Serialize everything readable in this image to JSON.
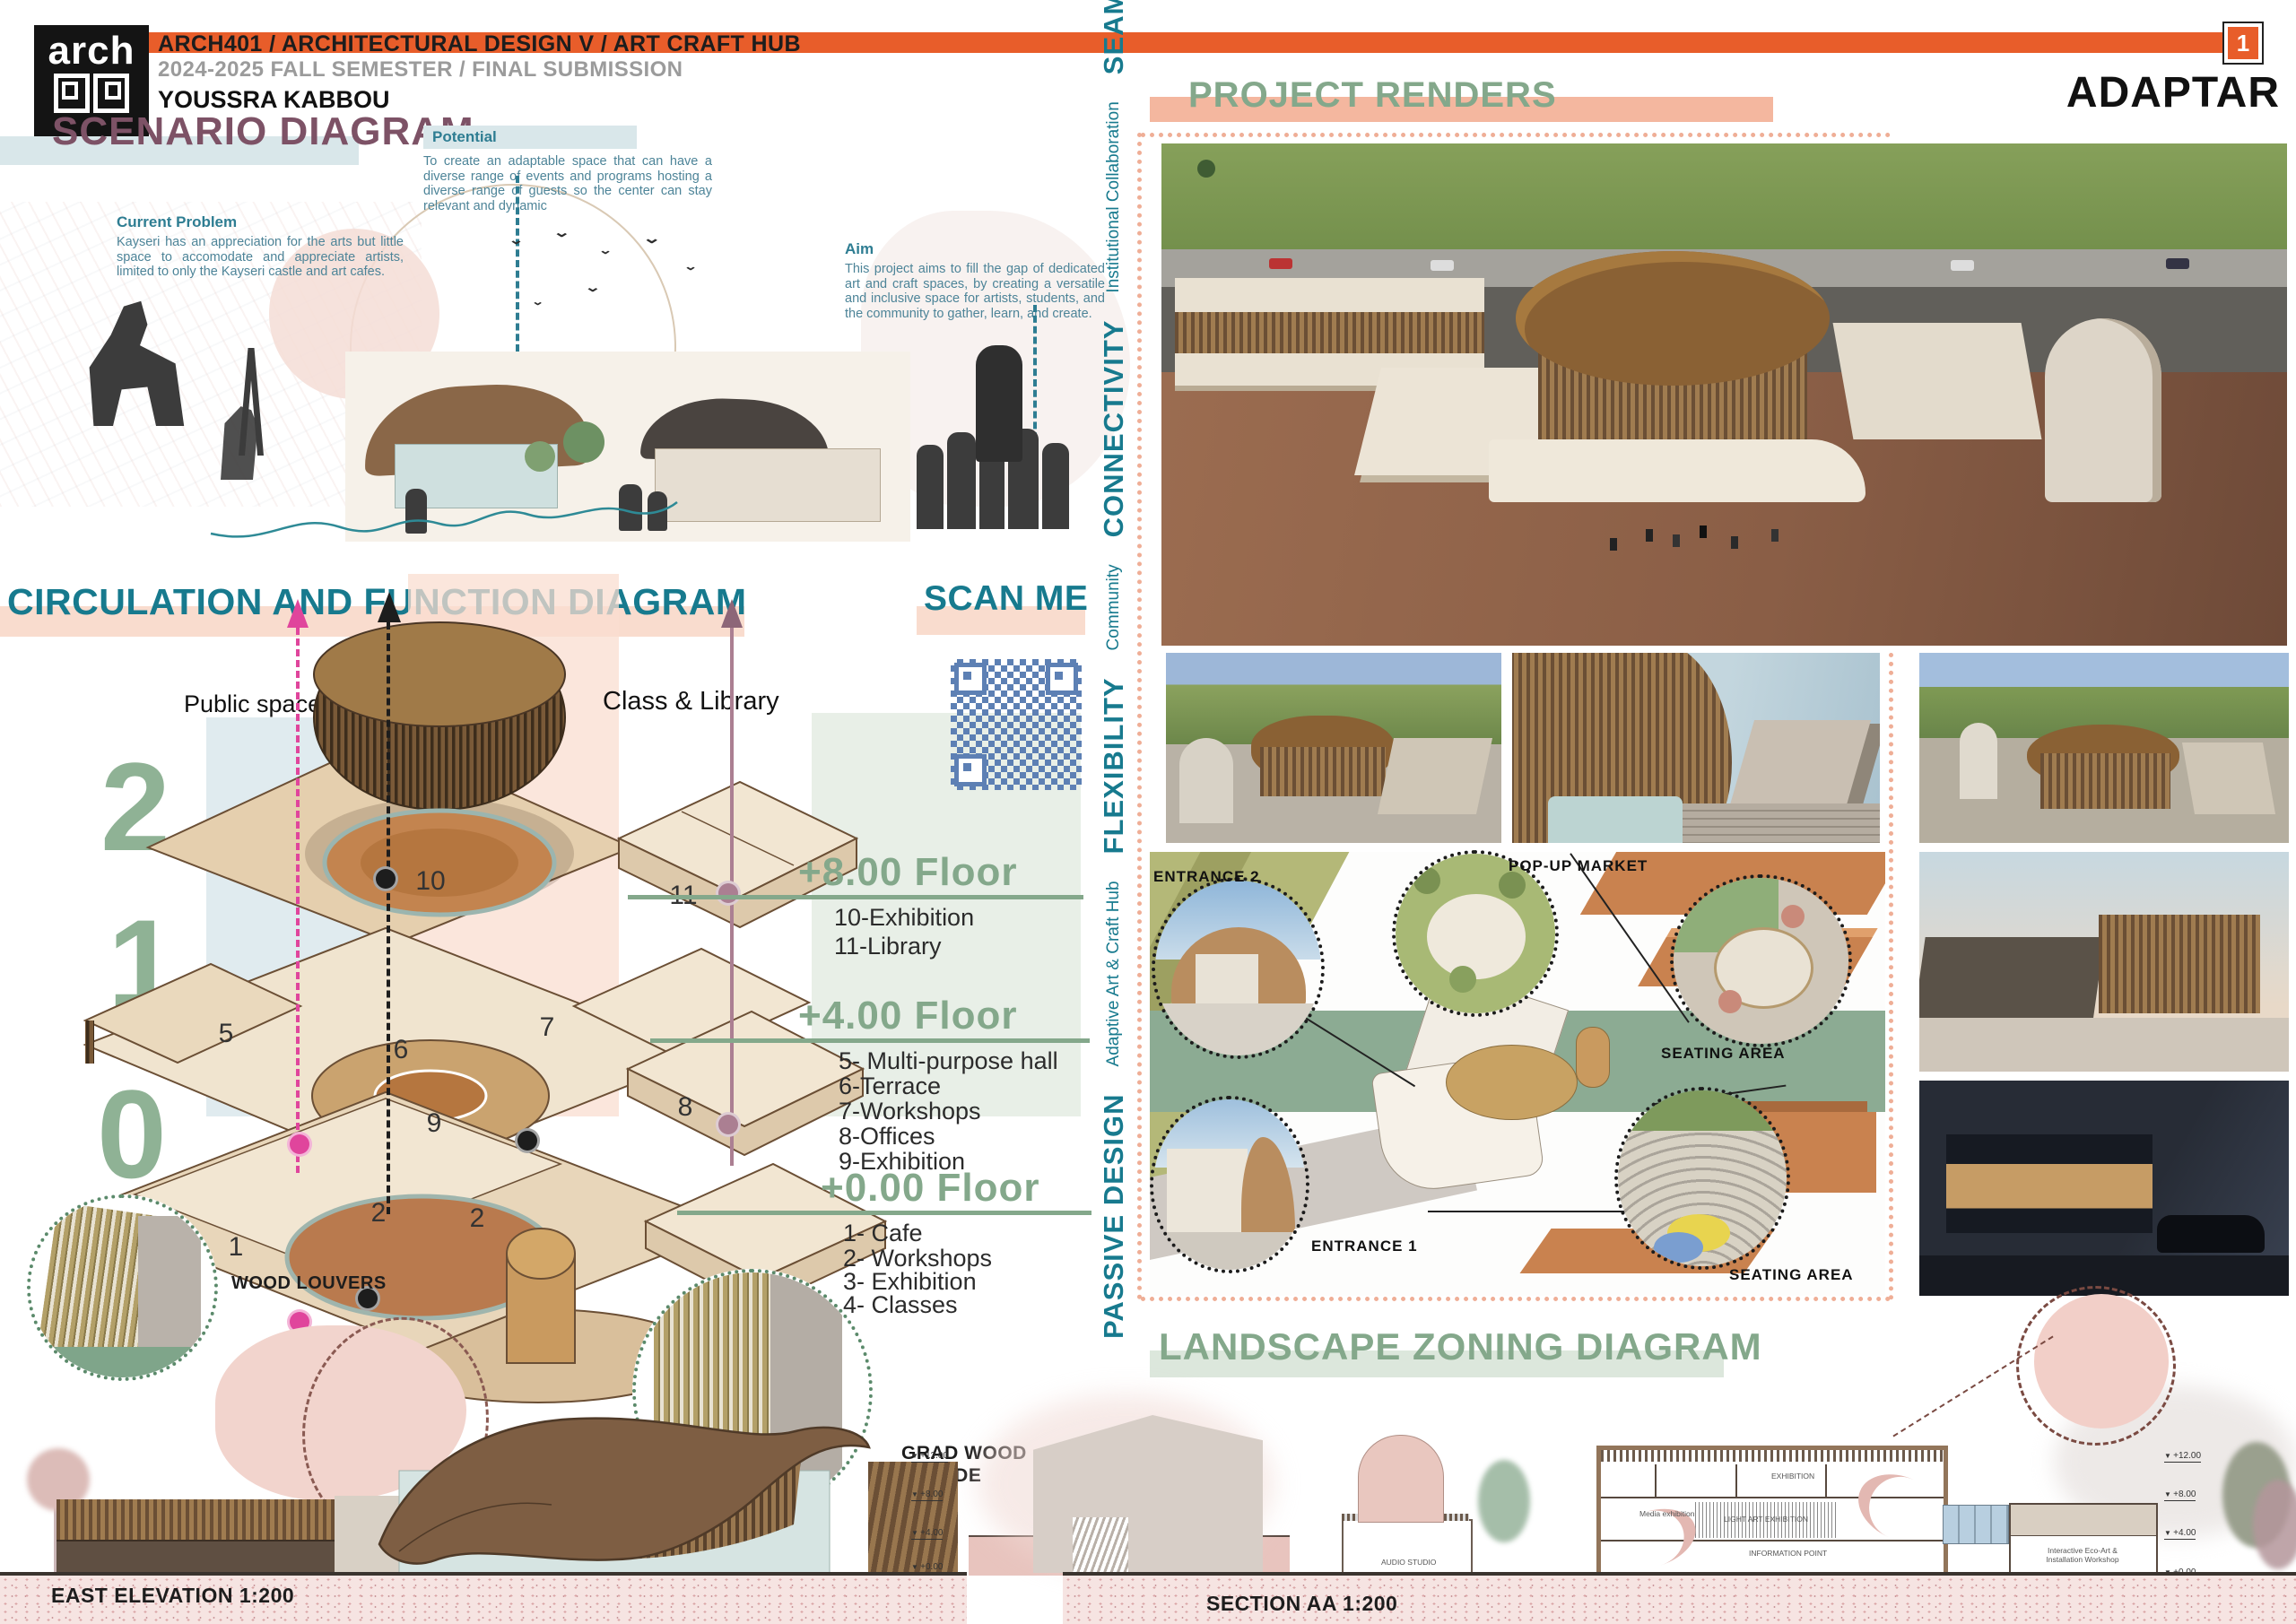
{
  "colors": {
    "accent_orange": "#e85d2a",
    "heading_plum": "#7d5266",
    "heading_teal": "#177a8e",
    "body_teal": "#4d8498",
    "sage_green": "#84a88b",
    "salmon_band": "#f4b79f",
    "dotted_frame": "#efae96",
    "qr_blue": "#5d80b4",
    "pink_arrow": "#e0459c",
    "mauve_arrow": "#ab7f92"
  },
  "header": {
    "logo_text": "arch",
    "course": "ARCH401 / ARCHITECTURAL DESIGN V / ART CRAFT HUB",
    "semester": "2024-2025 FALL SEMESTER / FINAL SUBMISSION",
    "author": "YOUSSRA KABBOU",
    "page_number": "1",
    "project_name": "ADAPTAR"
  },
  "scenario": {
    "title": "SCENARIO DIAGRAM",
    "blocks": [
      {
        "heading": "Current Problem",
        "body": "Kayseri has an appreciation for the arts but little space to accomodate and appreciate artists, limited to only the Kayseri castle and art cafes."
      },
      {
        "heading": "Potential",
        "body": "To create an adaptable space that can have a diverse range of events and programs hosting a diverse range of guests so the center can stay relevant and dynamic"
      },
      {
        "heading": "Aim",
        "body": "This project aims to fill the gap of dedicated art and craft spaces, by creating a versatile and inclusive space for artists, students, and the community to gather, learn, and create."
      }
    ]
  },
  "circulation": {
    "title": "CIRCULATION AND FUNCTION DIAGRAM",
    "scan_me": "SCAN ME",
    "axis_labels": {
      "public": "Public spaces",
      "class_library": "Class & Library"
    },
    "level_numbers": [
      "2",
      "1",
      "0"
    ],
    "floors": [
      {
        "name": "+8.00 Floor",
        "items": [
          "10-Exhibition",
          "11-Library"
        ]
      },
      {
        "name": "+4.00 Floor",
        "items": [
          "5- Multi-purpose hall",
          "6-Terrace",
          "7-Workshops",
          "8-Offices",
          "9-Exhibition"
        ]
      },
      {
        "name": "+0.00 Floor",
        "items": [
          "1- Cafe",
          "2- Workshops",
          "3- Exhibition",
          "4- Classes"
        ]
      }
    ],
    "axon_numbers": {
      "n10": "10",
      "n11": "11",
      "n5": "5",
      "n6": "6",
      "n7": "7",
      "n9": "9",
      "n8": "8",
      "n2a": "2",
      "n2b": "2",
      "n1": "1",
      "n4": "4"
    }
  },
  "details": {
    "wood_louvers": "WOOD LOUVERS",
    "grad_wood_line1": "GRAD WOOD",
    "grad_wood_line2": "FACADE"
  },
  "renders": {
    "title": "PROJECT RENDERS"
  },
  "values_strip": {
    "items": [
      {
        "emph": "PASSIVE DESIGN",
        "label": "Adaptive Art & Craft Hub"
      },
      {
        "emph": "FLEXIBILITY",
        "label": "Community"
      },
      {
        "emph": "CONNECTIVITY",
        "label": "Institutional Collaboration"
      },
      {
        "emph": "SEAMLESS",
        "label": "Accessibility"
      }
    ]
  },
  "landscape": {
    "title": "LANDSCAPE ZONING DIAGRAM",
    "labels": {
      "entrance2": "ENTRANCE 2",
      "popup_market": "POP-UP MARKET",
      "seating_area1": "SEATING AREA",
      "entrance1": "ENTRANCE 1",
      "seating_area2": "SEATING AREA"
    }
  },
  "elevation": {
    "label": "EAST ELEVATION 1:200",
    "levels": [
      "+12.00",
      "+8.00",
      "+4.00",
      "+0.00"
    ]
  },
  "section": {
    "label": "SECTION AA 1:200",
    "levels": [
      "+12.00",
      "+8.00",
      "+4.00",
      "+0.00",
      "-4.00"
    ],
    "rooms": {
      "exhibition": "EXHIBITION",
      "media": "Media exhibition",
      "light": "LIGHT ART EXHIBITION",
      "info": "INFORMATION POINT",
      "audio": "AUDIO STUDIO",
      "auditorium": "Auditorium",
      "technical": "Technical room",
      "eco": "Interactive Eco-Art & Installation Workshop"
    }
  }
}
